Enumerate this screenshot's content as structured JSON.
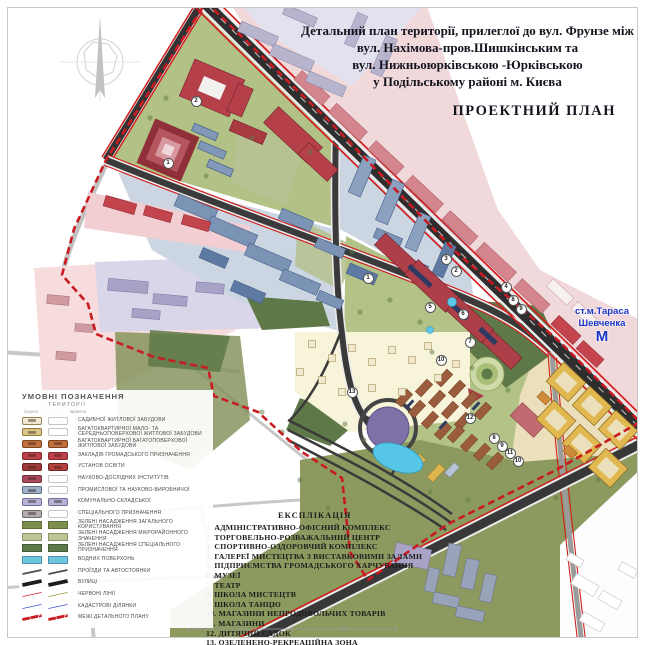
{
  "title": {
    "line1": "Детальний план території, прилеглої до вул. Фрунзе між",
    "line2": "вул. Нахімова-пров.Шишкінським та",
    "line3": "вул. Нижньоюрківською -Юрківською",
    "line4": "у Подільському районі м. Києва",
    "plan_label": "ПРОЕКТНИЙ ПЛАН"
  },
  "metro": {
    "name_line1": "ст.м.Тараса",
    "name_line2": "Шевченка",
    "symbol": "М",
    "color": "#1a35c8"
  },
  "legend": {
    "header": "УМОВНІ ПОЗНАЧЕННЯ",
    "subheader": "ТЕРИТОРІЇ",
    "col_existing": "існуючі",
    "col_projected": "проектні",
    "items": [
      {
        "label": "САДИБНОЇ ЖИТЛОВОЇ ЗАБУДОВИ",
        "kind": "area",
        "ex": "#f1ead0",
        "bd": "#8f8552",
        "pr": null
      },
      {
        "label": "БАГАТОКВАРТИРНОЇ МАЛО- ТА СЕРЕДНЬОПОВЕРХОВОЇ ЖИТЛОВОЇ ЗАБУДОВИ",
        "kind": "area",
        "ex": "#d9c78b",
        "bd": "#8f7a3a",
        "pr": null
      },
      {
        "label": "БАГАТОКВАРТИРНОЇ БАГАТОПОВЕРХОВОЇ ЖИТЛОВОЇ ЗАБУДОВИ",
        "kind": "area",
        "ex": "#c0703d",
        "bd": "#7c4520",
        "pr": "#c0703d"
      },
      {
        "label": "ЗАКЛАДІВ ГРОМАДСЬКОГО ПРИЗНАЧЕННЯ",
        "kind": "area",
        "ex": "#bf4049",
        "bd": "#7c2830",
        "pr": "#bf4049"
      },
      {
        "label": "УСТАНОВ ОСВІТИ",
        "kind": "area",
        "ex": "#9c3a3a",
        "bd": "#692525",
        "pr": "#b5413f"
      },
      {
        "label": "НАУКОВО-ДОСЛІДНИХ ІНСТИТУТІВ",
        "kind": "area",
        "ex": "#a84a58",
        "bd": "#70303a",
        "pr": null
      },
      {
        "label": "ПРОМИСЛОВОЇ ТА НАУКОВО-ВИРОБНИЧОЇ",
        "kind": "area",
        "ex": "#9fb0c8",
        "bd": "#5d7085",
        "pr": null
      },
      {
        "label": "КОМУНАЛЬНО-СКЛАДСЬКОЇ",
        "kind": "area",
        "ex": "#b5b3d6",
        "bd": "#6f6d96",
        "pr": "#b5b3d6"
      },
      {
        "label": "СПЕЦІАЛЬНОГО ПРИЗНАЧЕННЯ",
        "kind": "area",
        "ex": "#b3aeae",
        "bd": "#6e6a6a",
        "pr": null
      },
      {
        "label": "ЗЕЛЕНІ НАСАДЖЕННЯ ЗАГАЛЬНОГО КОРИСТУВАННЯ",
        "kind": "fill",
        "ex": "#7c8f4d",
        "pr": "#7c8f4d"
      },
      {
        "label": "ЗЕЛЕНІ НАСАДЖЕННЯ МІКРОРАЙОННОГО ЗНАЧЕННЯ",
        "kind": "fill",
        "ex": "#bdc795",
        "pr": "#bdc795"
      },
      {
        "label": "ЗЕЛЕНІ НАСАДЖЕННЯ СПЕЦІАЛЬНОГО ПРИЗНАЧЕННЯ",
        "kind": "fill",
        "ex": "#5d7a4a",
        "pr": "#5d7a4a"
      },
      {
        "label": "ВОДНИХ ПОВЕРХОНЬ",
        "kind": "fill",
        "ex": "#6ec5e2",
        "pr": "#6ec5e2"
      },
      {
        "label": "ПРОЇЗДИ ТА АВТОСТОЯНКИ",
        "kind": "line",
        "ex": "#4a4a4a",
        "pr": "#4a4a4a",
        "w": 2
      },
      {
        "label": "ВУЛИЦІ",
        "kind": "line",
        "ex": "#1c1c1c",
        "pr": "#1c1c1c",
        "w": 4
      },
      {
        "label": "ЧЕРВОНІ ЛІНІЇ",
        "kind": "line",
        "ex": "#d21f1f",
        "pr": "#9a8f3e",
        "w": 1.5
      },
      {
        "label": "КАДАСТРОВІ ДІЛЯНКИ",
        "kind": "line",
        "ex": "#3a4ec8",
        "pr": "#3a4ec8",
        "w": 1.5
      },
      {
        "label": "МЕЖІ ДЕТАЛЬНОГО ПЛАНУ",
        "kind": "dash",
        "ex": "#c81b22",
        "pr": "#c81b22",
        "w": 3
      }
    ]
  },
  "explication": {
    "header": "ЕКСПЛІКАЦІЯ",
    "items": [
      "1. АДМІНІСТРАТИВНО-ОФІСНИЙ КОМПЛЕКС",
      "2. ТОРГОВЕЛЬНО-РОЗВАЖАЛЬНИЙ ЦЕНТР",
      "3. СПОРТИВНО-ОЗДОРОВЧИЙ КОМПЛЕКС",
      "4. ГАЛЕРЕЇ МИСТЕЦТВА З ВИСТАВКОВИМИ ЗАЛАМИ",
      "5. ПІДПРИЄМСТВА ГРОМАДСЬКОГО ХАРЧУВАННЯ",
      "6. МУЗЕЇ",
      "7. ТЕАТР",
      "8. ШКОЛА МИСТЕЦТВ",
      "9. ШКОЛА ТАНЦЮ",
      "10. МАГАЗИНИ НЕПРОДОВОЛЬЧИХ ТОВАРІВ",
      "11. МАГАЗИНИ",
      "12. ДИТЯЧИЙ САДОК",
      "13. ОЗЕЛЕНЕНО-РЕКРЕАЦІЙНА ЗОНА"
    ]
  },
  "markers": [
    {
      "n": "1",
      "x": 168,
      "y": 163
    },
    {
      "n": "2",
      "x": 196,
      "y": 101
    },
    {
      "n": "1",
      "x": 368,
      "y": 278
    },
    {
      "n": "3",
      "x": 446,
      "y": 259
    },
    {
      "n": "2",
      "x": 456,
      "y": 271
    },
    {
      "n": "4",
      "x": 506,
      "y": 287
    },
    {
      "n": "5",
      "x": 430,
      "y": 307
    },
    {
      "n": "6",
      "x": 463,
      "y": 314
    },
    {
      "n": "8",
      "x": 513,
      "y": 300
    },
    {
      "n": "9",
      "x": 521,
      "y": 309
    },
    {
      "n": "7",
      "x": 470,
      "y": 342
    },
    {
      "n": "10",
      "x": 441,
      "y": 360
    },
    {
      "n": "12",
      "x": 470,
      "y": 418
    },
    {
      "n": "8",
      "x": 494,
      "y": 438
    },
    {
      "n": "9",
      "x": 502,
      "y": 446
    },
    {
      "n": "11",
      "x": 510,
      "y": 453
    },
    {
      "n": "10",
      "x": 518,
      "y": 461
    },
    {
      "n": "13",
      "x": 352,
      "y": 392
    }
  ],
  "map_colors": {
    "boundary": "#c81b22",
    "street_major": "#2e2e2e",
    "red_line": "#d11f1f",
    "water": "#55c6e6",
    "interchange_circle": "#7e71a8",
    "park_green": "#b3c287",
    "special_green": "#8c9a60",
    "industrial_blue": "#7b93b4",
    "public_red": "#ae3e48",
    "residential_brown": "#9a5c3c",
    "existing_tan": "#e0b84f"
  }
}
